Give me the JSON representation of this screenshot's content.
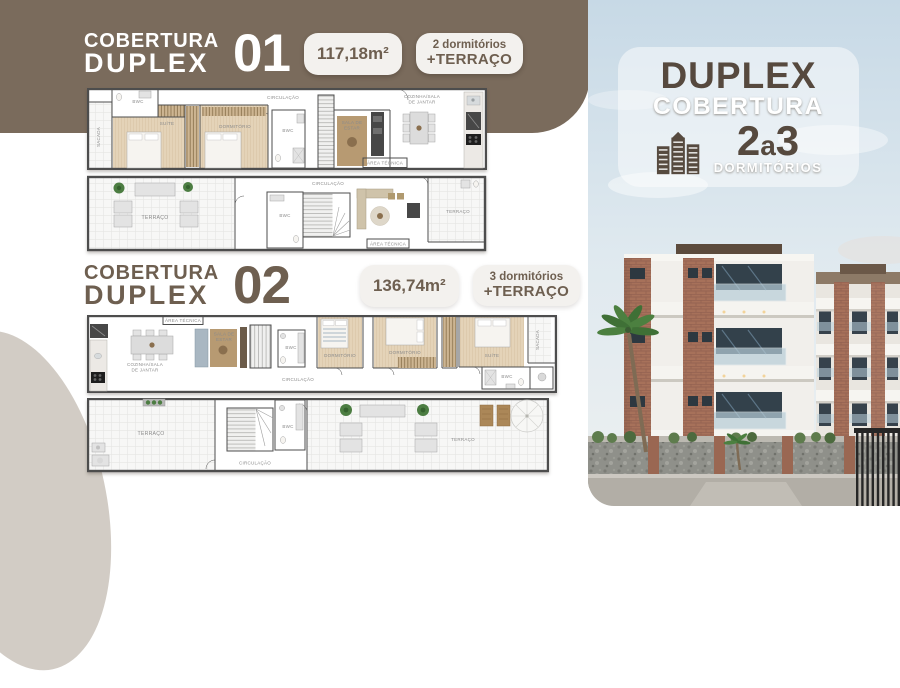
{
  "header1": {
    "kicker": "COBERTURA",
    "name": "DUPLEX",
    "number": "01",
    "area": "117,18m²",
    "rooms1": "2 dormitórios",
    "rooms2": "+TERRAÇO"
  },
  "header2": {
    "kicker": "COBERTURA",
    "name": "DUPLEX",
    "number": "02",
    "area": "136,74m²",
    "rooms1": "3 dormitórios",
    "rooms2": "+TERRAÇO"
  },
  "side": {
    "line1": "DUPLEX",
    "line2": "COBERTURA",
    "num1": "2",
    "mid": "a",
    "num2": "3",
    "label": "DORMITÓRIOS"
  },
  "plans": {
    "d1f1": {
      "sacada": "SACADA",
      "bwc1": "BWC",
      "suite": "SUÍTE",
      "dormitorio": "DORMITÓRIO",
      "circulacao": "CIRCULAÇÃO",
      "bwc2": "BWC",
      "sala1": "SALA DE",
      "sala2": "ESTAR",
      "coz1": "COZINHA/SALA",
      "coz2": "DE JANTAR",
      "areatec": "ÁREA TÉCNICA"
    },
    "d1f2": {
      "terraco1": "TERRAÇO",
      "bwc": "BWC",
      "circulacao": "CIRCULAÇÃO",
      "areatec": "ÁREA TÉCNICA",
      "terraco2": "TERRAÇO"
    },
    "d2f1": {
      "areatec": "ÁREA TÉCNICA",
      "coz1": "COZINHA/SALA",
      "coz2": "DE JANTAR",
      "sala1": "SALA DE",
      "sala2": "ESTAR",
      "bwc1": "BWC",
      "circulacao": "CIRCULAÇÃO",
      "dorm1": "DORMITÓRIO",
      "dorm2": "DORMITÓRIO",
      "suite": "SUÍTE",
      "sacada": "SACADA",
      "bwc2": "BWC"
    },
    "d2f2": {
      "terraco1": "TERRAÇO",
      "circulacao": "CIRCULAÇÃO",
      "bwc": "BWC",
      "terraco2": "TERRAÇO"
    }
  },
  "colors": {
    "band": "#7a6b5c",
    "accent": "#56493e",
    "badge_text": "#6e5f50",
    "brick": "#a7715a",
    "sky": "#c7d9e6"
  }
}
